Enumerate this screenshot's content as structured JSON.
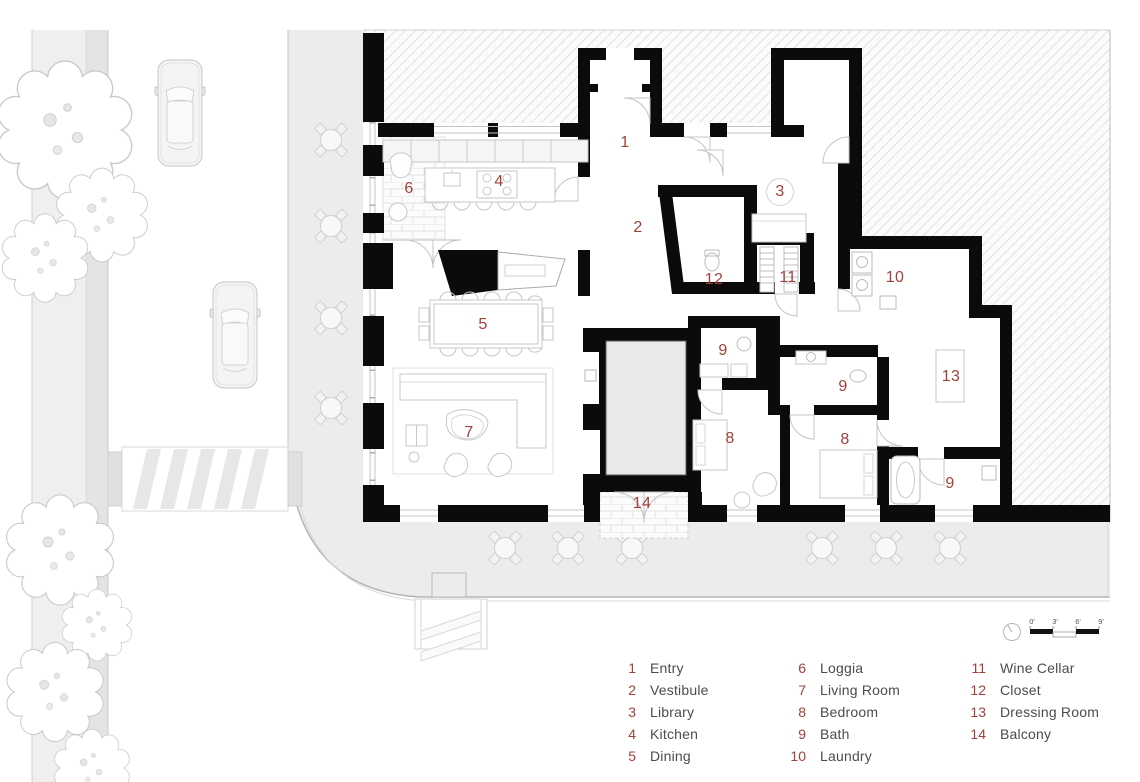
{
  "plan": {
    "room_labels": [
      {
        "n": "1",
        "x": 625,
        "y": 143,
        "circled": false
      },
      {
        "n": "2",
        "x": 638,
        "y": 228,
        "circled": false
      },
      {
        "n": "3",
        "x": 780,
        "y": 192,
        "circled": true
      },
      {
        "n": "4",
        "x": 499,
        "y": 182,
        "circled": false
      },
      {
        "n": "5",
        "x": 483,
        "y": 325,
        "circled": false
      },
      {
        "n": "6",
        "x": 409,
        "y": 189,
        "circled": false
      },
      {
        "n": "7",
        "x": 469,
        "y": 433,
        "circled": false
      },
      {
        "n": "9",
        "x": 723,
        "y": 351,
        "circled": false
      },
      {
        "n": "12",
        "x": 714,
        "y": 280,
        "circled": false
      },
      {
        "n": "11",
        "x": 788,
        "y": 278,
        "circled": false
      },
      {
        "n": "10",
        "x": 895,
        "y": 278,
        "circled": false
      },
      {
        "n": "9",
        "x": 843,
        "y": 387,
        "circled": false
      },
      {
        "n": "13",
        "x": 951,
        "y": 377,
        "circled": false
      },
      {
        "n": "8",
        "x": 730,
        "y": 439,
        "circled": false
      },
      {
        "n": "8",
        "x": 845,
        "y": 440,
        "circled": false
      },
      {
        "n": "9",
        "x": 950,
        "y": 484,
        "circled": false
      },
      {
        "n": "14",
        "x": 642,
        "y": 504,
        "circled": false
      }
    ]
  },
  "legend": {
    "columns": [
      {
        "items": [
          {
            "n": "1",
            "label": "Entry"
          },
          {
            "n": "2",
            "label": "Vestibule"
          },
          {
            "n": "3",
            "label": "Library"
          },
          {
            "n": "4",
            "label": "Kitchen"
          },
          {
            "n": "5",
            "label": "Dining"
          }
        ]
      },
      {
        "items": [
          {
            "n": "6",
            "label": "Loggia"
          },
          {
            "n": "7",
            "label": "Living Room"
          },
          {
            "n": "8",
            "label": "Bedroom"
          },
          {
            "n": "9",
            "label": "Bath"
          },
          {
            "n": "10",
            "label": "Laundry"
          }
        ]
      },
      {
        "items": [
          {
            "n": "11",
            "label": "Wine Cellar"
          },
          {
            "n": "12",
            "label": "Closet"
          },
          {
            "n": "13",
            "label": "Dressing Room"
          },
          {
            "n": "14",
            "label": "Balcony"
          }
        ]
      }
    ]
  },
  "scale_bar": {
    "ticks": [
      "0'",
      "3'",
      "6'",
      "9'"
    ]
  },
  "colors": {
    "accent": "#a0413b",
    "wall": "#0b0b0b",
    "legend_text": "#4c4c4c",
    "hatch_line": "#d7d7d7",
    "sidewalk": "#ededed",
    "furniture_line": "#c7c7c7"
  }
}
